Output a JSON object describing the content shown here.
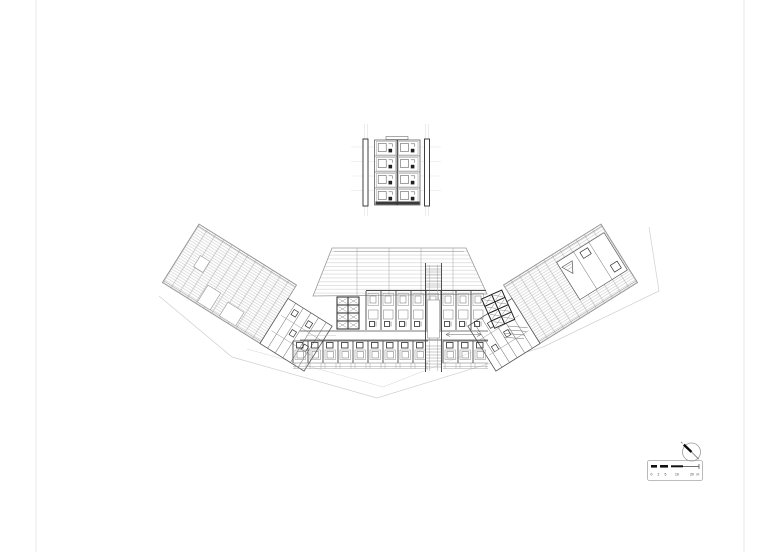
{
  "sheet": {
    "background": "#ffffff",
    "border_color": "#e9e9e9"
  },
  "colors": {
    "ink_dark": "#1f1f1f",
    "ink": "#555555",
    "ink_light": "#9a9a9a",
    "hatch": "#c3c3c3",
    "faint": "#d6d6d6"
  },
  "scale_bar": {
    "labels": [
      "0",
      "2",
      "5",
      "10",
      "20"
    ],
    "unit": "m"
  },
  "north_arrow": {
    "symbol": "compass-needle"
  },
  "main_plan": {
    "top_row_rooms": 8,
    "bottom_row_rooms_left": 9,
    "bottom_row_rooms_right": 3,
    "elevator_grid": {
      "cols": 2,
      "rows": 4
    },
    "junction_room_bays": 6
  },
  "detail_plan": {
    "rows": 4,
    "cols": 2
  }
}
